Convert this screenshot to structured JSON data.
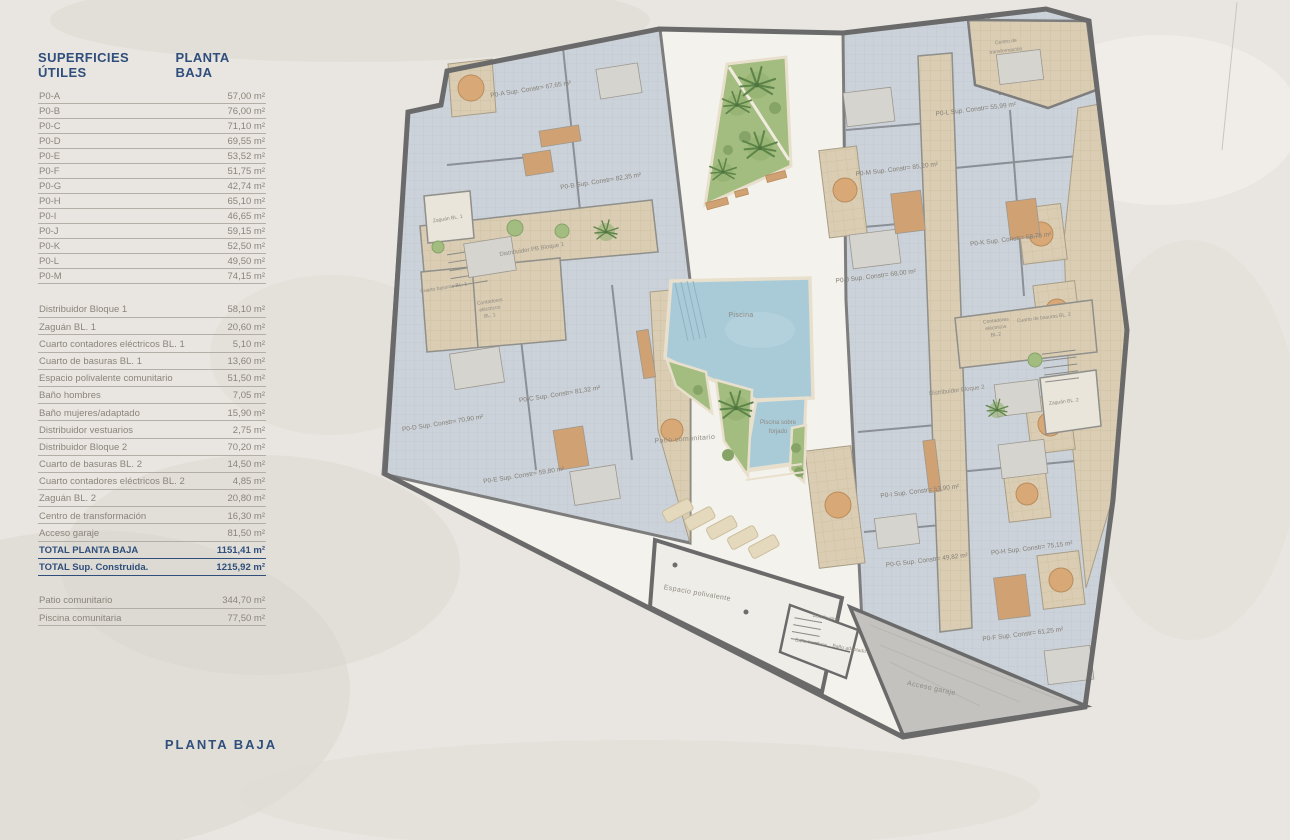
{
  "table": {
    "header": {
      "left": "SUPERFICIES ÚTILES",
      "right": "PLANTA BAJA"
    },
    "apartments": [
      {
        "label": "P0-A",
        "value": "57,00 m²"
      },
      {
        "label": "P0-B",
        "value": "76,00 m²"
      },
      {
        "label": "P0-C",
        "value": "71,10 m²"
      },
      {
        "label": "P0-D",
        "value": "69,55 m²"
      },
      {
        "label": "P0-E",
        "value": "53,52 m²"
      },
      {
        "label": "P0-F",
        "value": "51,75 m²"
      },
      {
        "label": "P0-G",
        "value": "42,74 m²"
      },
      {
        "label": "P0-H",
        "value": "65,10 m²"
      },
      {
        "label": "P0-I",
        "value": "46,65 m²"
      },
      {
        "label": "P0-J",
        "value": "59,15 m²"
      },
      {
        "label": "P0-K",
        "value": "52,50 m²"
      },
      {
        "label": "P0-L",
        "value": "49,50 m²"
      },
      {
        "label": "P0-M",
        "value": "74,15 m²"
      }
    ],
    "rooms": [
      {
        "label": "Distribuidor Bloque 1",
        "value": "58,10 m²"
      },
      {
        "label": "Zaguán BL. 1",
        "value": "20,60 m²"
      },
      {
        "label": "Cuarto contadores eléctricos BL. 1",
        "value": "5,10 m²"
      },
      {
        "label": "Cuarto de basuras BL. 1",
        "value": "13,60 m²"
      },
      {
        "label": "Espacio polivalente comunitario",
        "value": "51,50 m²"
      },
      {
        "label": "Baño hombres",
        "value": "7,05 m²"
      },
      {
        "label": "Baño mujeres/adaptado",
        "value": "15,90 m²"
      },
      {
        "label": "Distribuidor vestuarios",
        "value": "2,75 m²"
      },
      {
        "label": "Distribuidor Bloque 2",
        "value": "70,20 m²"
      },
      {
        "label": "Cuarto de basuras BL. 2",
        "value": "14,50 m²"
      },
      {
        "label": "Cuarto contadores eléctricos BL. 2",
        "value": "4,85 m²"
      },
      {
        "label": "Zaguán BL. 2",
        "value": "20,80 m²"
      },
      {
        "label": "Centro de transformación",
        "value": "16,30 m²"
      },
      {
        "label": "Acceso garaje",
        "value": "81,50 m²"
      }
    ],
    "totals": [
      {
        "label": "TOTAL PLANTA BAJA",
        "value": "1151,41 m²"
      },
      {
        "label": "TOTAL Sup. Construida.",
        "value": "1215,92 m²"
      }
    ],
    "outdoor": [
      {
        "label": "Patio comunitario",
        "value": "344,70 m²"
      },
      {
        "label": "Piscina comunitaria",
        "value": "77,50 m²"
      }
    ]
  },
  "caption": "PLANTA BAJA",
  "plan": {
    "apartments": {
      "a": "P0-A Sup. Constr= 67,65 m²",
      "b": "P0-B Sup. Constr= 82,35 m²",
      "c": "P0-C Sup. Constr= 81,32 m²",
      "d": "P0-D Sup. Constr= 70,90 m²",
      "e": "P0-E Sup. Constr= 59,80 m²",
      "f": "P0-F Sup. Constr= 61,25 m²",
      "g": "P0-G Sup. Constr= 49,82 m²",
      "h": "P0-H Sup. Constr= 75,15 m²",
      "i": "P0-I Sup. Constr= 53,90 m²",
      "j": "P0-J Sup. Constr= 68,00 m²",
      "k": "P0-K Sup. Constr= 58,75 m²",
      "l": "P0-L Sup. Constr= 55,99 m²",
      "m": "P0-M Sup. Constr= 85,20 m²"
    },
    "common": {
      "zaguan1": "Zaguán BL. 1",
      "distribuidor1": "Distribuidor PB Bloque 1",
      "basuras1": "Cuarto basuras BL. 1",
      "contadores1": [
        "Contadores",
        "eléctricos",
        "BL. 1"
      ],
      "distribuidor2": "Distribuidor Bloque 2",
      "zaguan2": "Zaguán BL. 2",
      "basuras2": "Cuarto de basuras BL. 2",
      "contadores2": [
        "Contadores",
        "eléctricos",
        "BL.2"
      ],
      "centro": [
        "Centro de",
        "transformación"
      ],
      "patio": "Patio comunitario",
      "piscina": "Piscina",
      "piscina_forjado": [
        "Piscina sobre",
        "forjado"
      ],
      "espacio": "Espacio polivalente",
      "distribuidor_pb": "Distribuidor",
      "bano_hombres": "Baño hombres",
      "bano_adaptado": "Baño adaptado",
      "acceso": "Acceso garaje"
    },
    "colors": {
      "accent_navy": "#2f4e7c",
      "text_gray": "#8a857c",
      "wall": "#6a6a6a",
      "apartment_floor": "#ccd2d9",
      "common_floor": "#dacdb3",
      "patio": "#f4f2ec",
      "pool": "#a9cbd8",
      "garden": "#a3bc80",
      "ramp": "#c3c2bf",
      "paper": "#e9e6e1"
    }
  }
}
